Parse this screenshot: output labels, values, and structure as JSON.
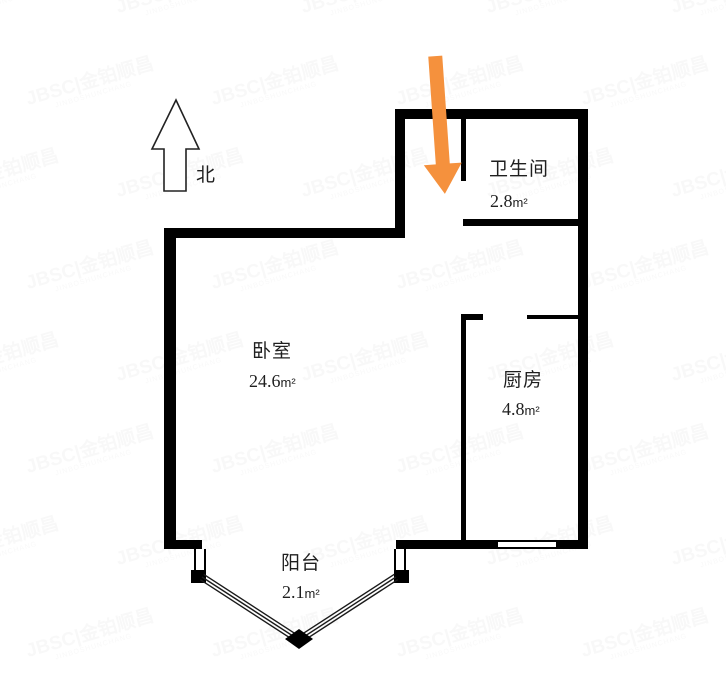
{
  "compass": {
    "label": "北"
  },
  "rooms": {
    "bedroom": {
      "name": "卧室",
      "area_value": "24.6",
      "area_unit": "m²"
    },
    "bathroom": {
      "name": "卫生间",
      "area_value": "2.8",
      "area_unit": "m²"
    },
    "kitchen": {
      "name": "厨房",
      "area_value": "4.8",
      "area_unit": "m²"
    },
    "balcony": {
      "name": "阳台",
      "area_value": "2.1",
      "area_unit": "m²"
    }
  },
  "entrance_arrow": {
    "color": "#F5913D"
  },
  "watermark": {
    "text": "JBSC|金铂顺昌",
    "subtext": "JINBOSHUNCHANG"
  },
  "colors": {
    "wall": "#000000",
    "text": "#1f1f1f",
    "watermark": "#8a8a8a"
  }
}
